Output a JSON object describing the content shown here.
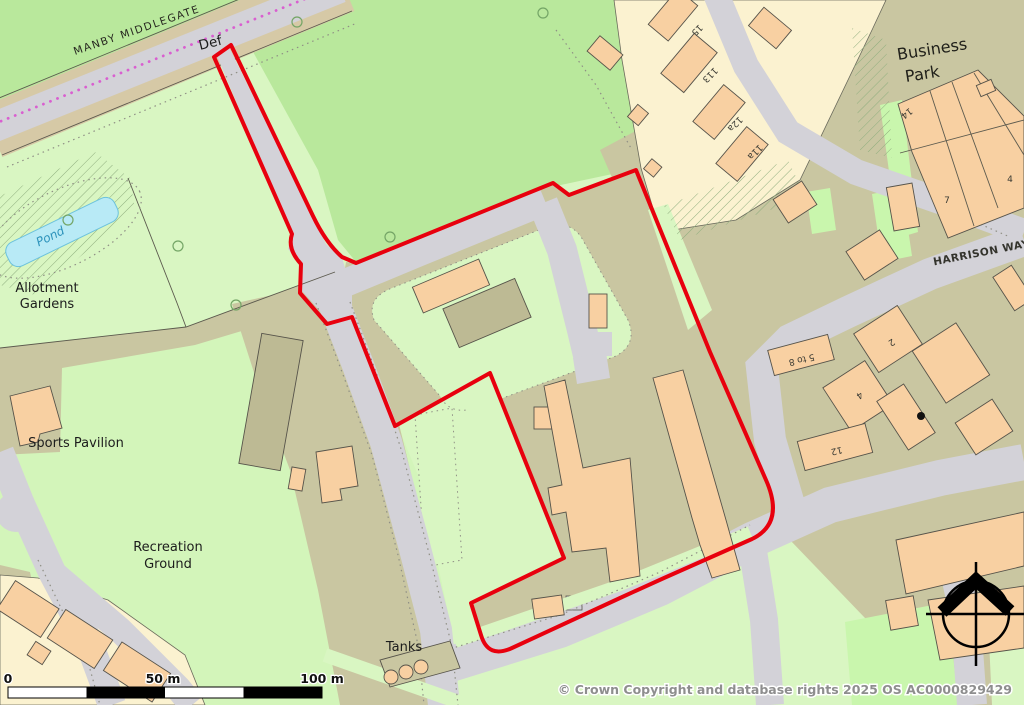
{
  "map": {
    "roads": {
      "manby_middlegate": "MANBY MIDDLEGATE",
      "harrison_way": "HARRISON WAY",
      "def": "Def"
    },
    "places": {
      "pond": "Pond",
      "allotment_line1": "Allotment",
      "allotment_line2": "Gardens",
      "sports_pavilion": "Sports Pavilion",
      "recreation_line1": "Recreation",
      "recreation_line2": "Ground",
      "tanks": "Tanks",
      "business_line1": "Business",
      "business_line2": "Park"
    },
    "house_numbers": {
      "n15": "15",
      "n113": "113",
      "n12a": "12a",
      "n11a": "11a",
      "n14": "14",
      "n7": "7",
      "n4_bp": "4",
      "n2": "2",
      "n4": "4",
      "n5to8": "5 to 8",
      "n12": "12"
    },
    "scale_bar": {
      "start": "0",
      "mid": "50 m",
      "end": "100 m"
    },
    "attribution": "© Crown Copyright and database rights 2025 OS AC0000829429",
    "colors": {
      "boundary_red": "#e8000e",
      "field_green": "#b9e89c",
      "grass_pale": "#d9f6c2",
      "yard_khaki": "#c9c6a1",
      "road_grey": "#d3d2d8",
      "road_edge_tan": "#d6c9a6",
      "plot_cream": "#fbf2d0",
      "building_salmon": "#f8d0a2",
      "pond_blue": "#b8eaf6",
      "footpath_magenta": "#d95fd0"
    }
  }
}
